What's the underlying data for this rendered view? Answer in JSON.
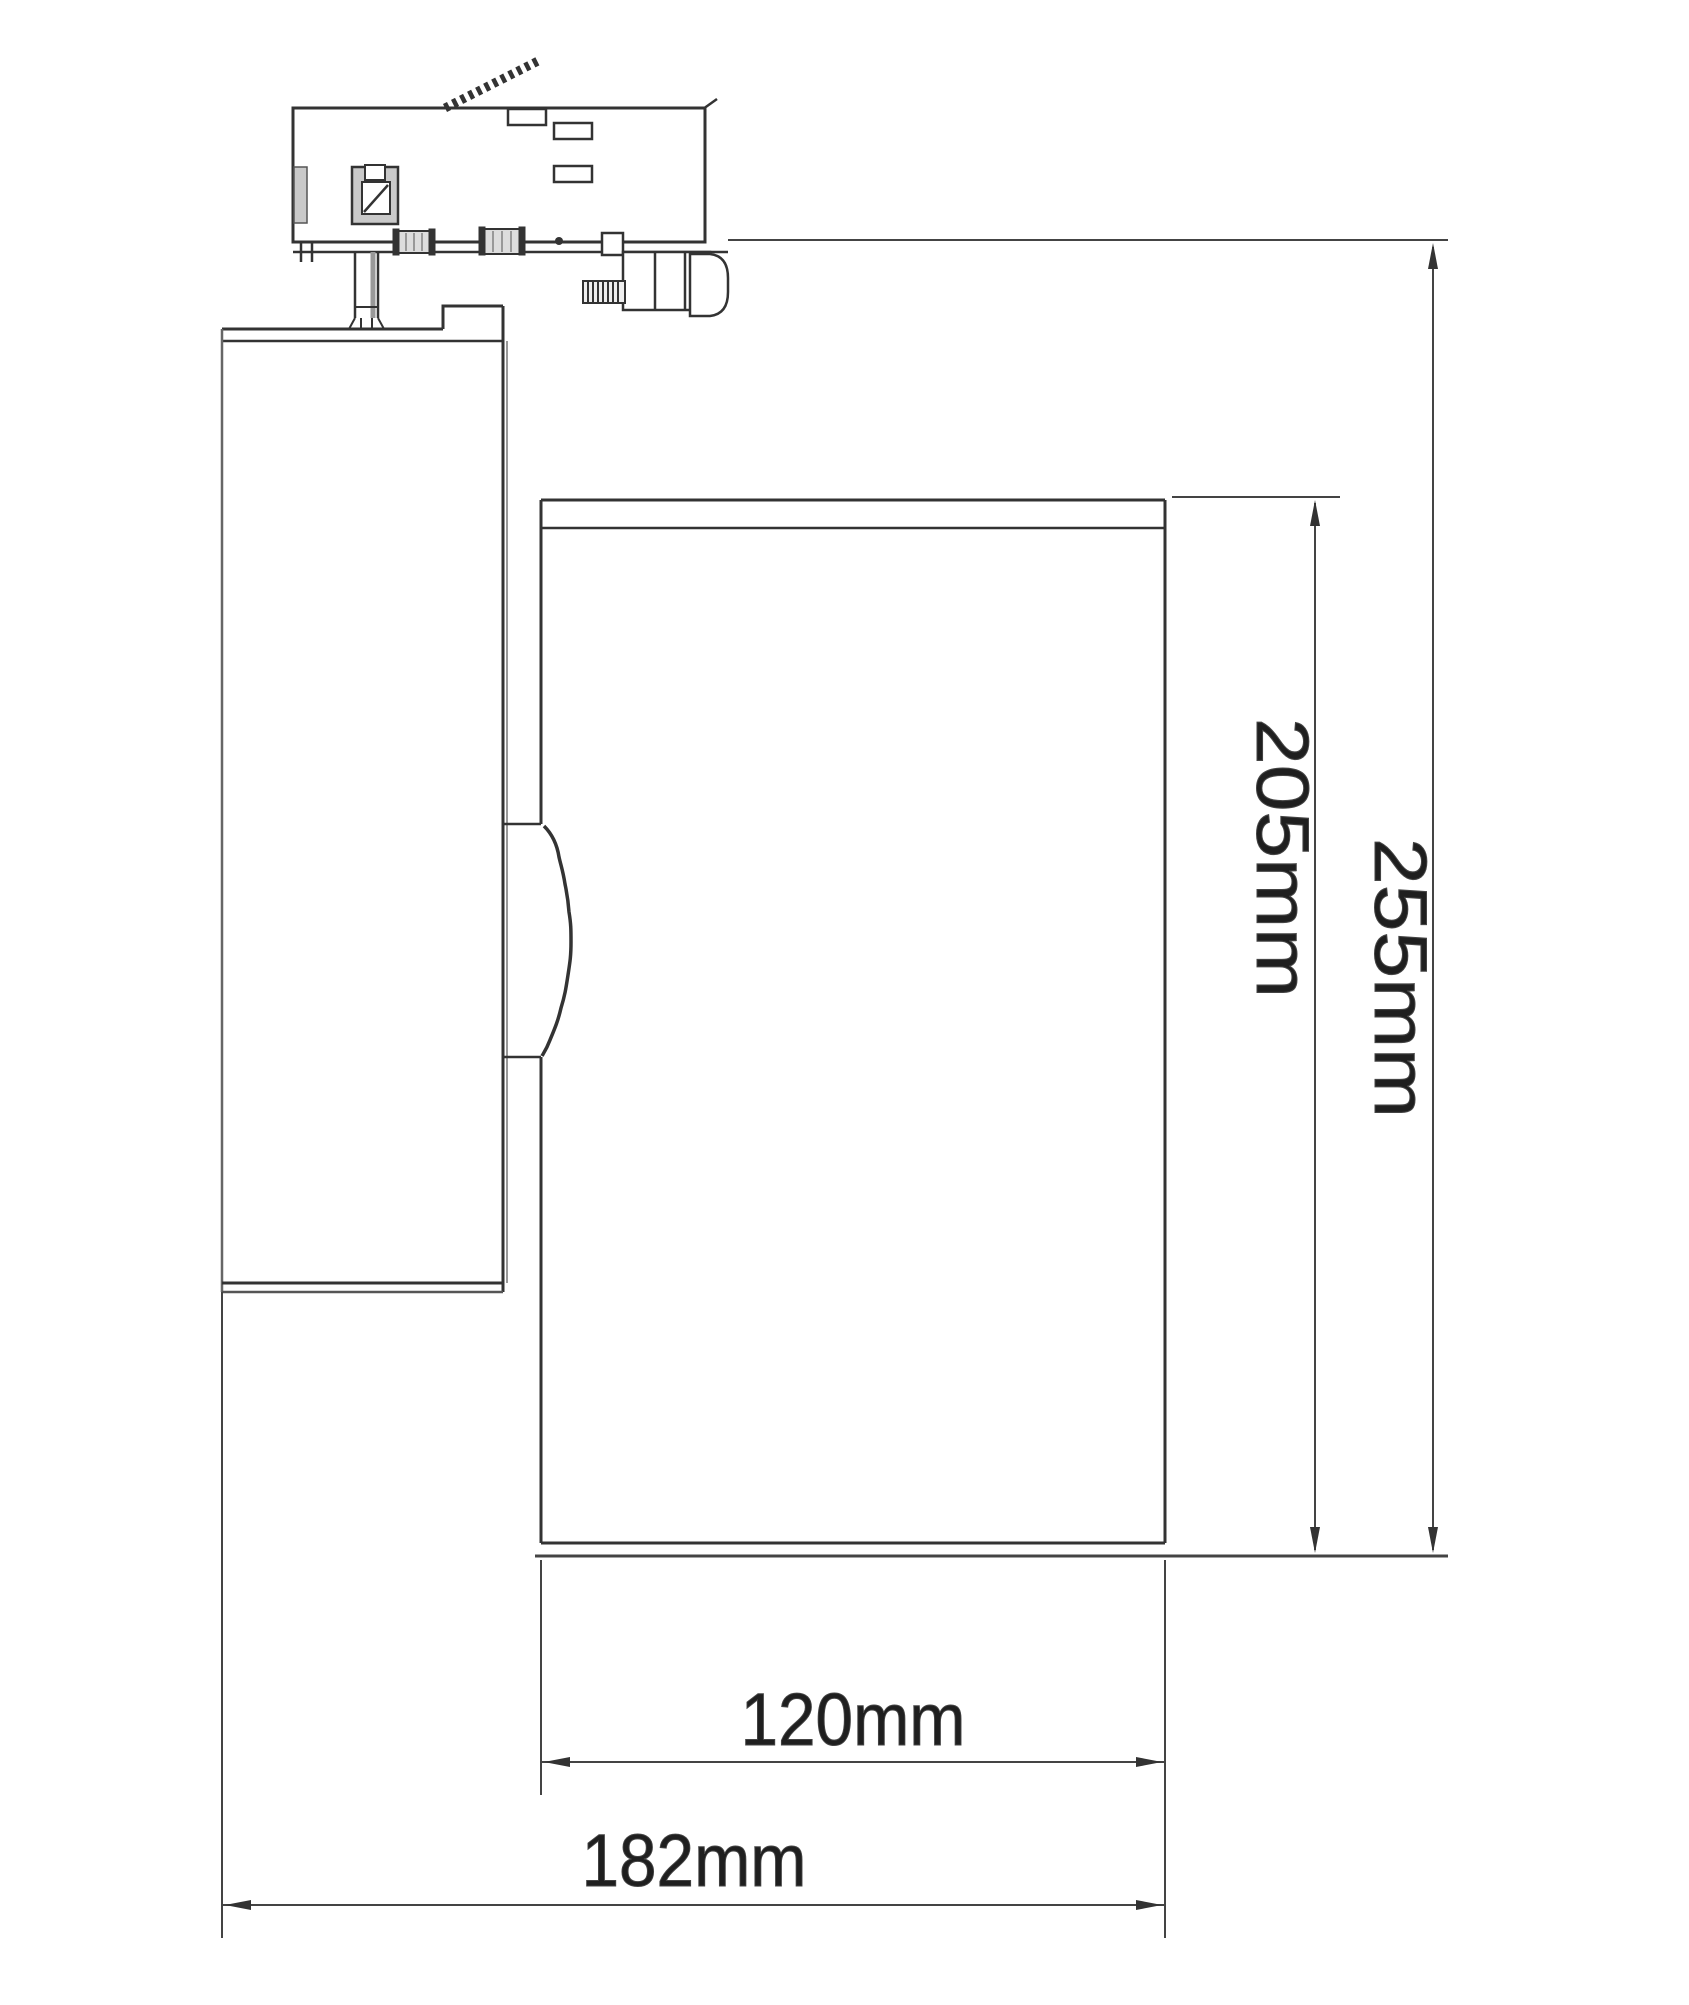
{
  "figure": {
    "background": "#ffffff",
    "line_color": "#333333",
    "soft_line_color": "#7a7a7a",
    "shade_color": "#c9c9c9"
  },
  "dimensions": {
    "head_height": {
      "label": "205mm"
    },
    "overall_height": {
      "label": "255mm"
    },
    "head_width": {
      "label": "120mm"
    },
    "overall_length": {
      "label": "182mm"
    }
  }
}
